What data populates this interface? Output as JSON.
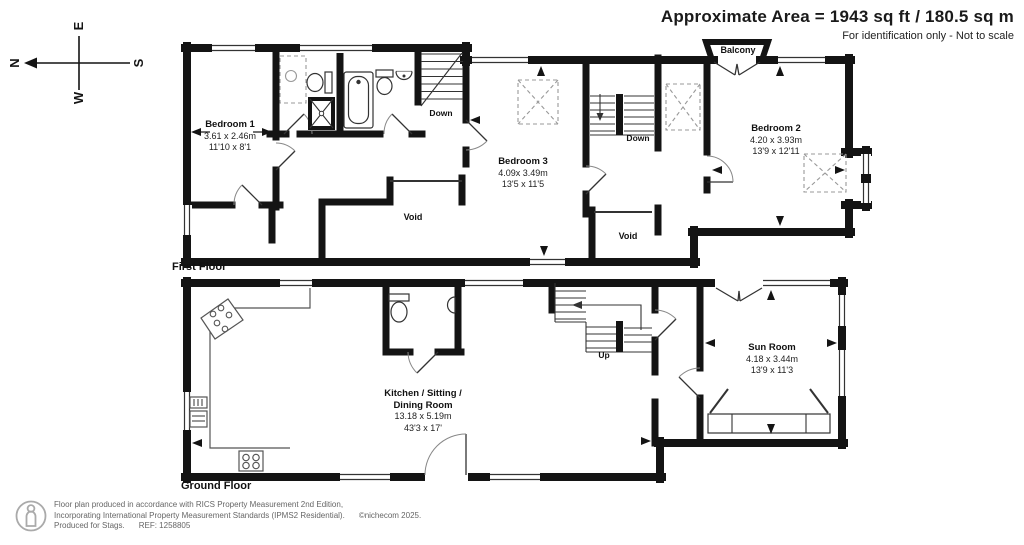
{
  "header": {
    "title": "Approximate Area = 1943 sq ft / 180.5 sq m",
    "subtitle": "For identification only - Not to scale"
  },
  "compass": {
    "north": "N",
    "south": "S",
    "east": "E",
    "west": "W"
  },
  "first_floor": {
    "label": "First Floor",
    "bedroom1": {
      "name": "Bedroom 1",
      "metric": "3.61 x 2.46m",
      "imperial": "11'10 x 8'1"
    },
    "bedroom3": {
      "name": "Bedroom 3",
      "metric": "4.09x 3.49m",
      "imperial": "13'5 x 11'5"
    },
    "bedroom2": {
      "name": "Bedroom 2",
      "metric": "4.20 x 3.93m",
      "imperial": "13'9 x 12'11"
    },
    "balcony": "Balcony",
    "void_left": "Void",
    "void_right": "Void",
    "down_left": "Down",
    "down_right": "Down"
  },
  "ground_floor": {
    "label": "Ground Floor",
    "kitchen": {
      "name1": "Kitchen / Sitting /",
      "name2": "Dining Room",
      "metric": "13.18 x 5.19m",
      "imperial": "43'3 x 17'"
    },
    "sunroom": {
      "name": "Sun Room",
      "metric": "4.18 x 3.44m",
      "imperial": "13'9 x 11'3"
    },
    "up": "Up"
  },
  "footer": {
    "line1": "Floor plan produced in accordance with RICS Property Measurement 2nd Edition,",
    "line2": "Incorporating International Property Measurement Standards (IPMS2 Residential).",
    "copyright": "©nichecom 2025.",
    "produced": "Produced for Stags.",
    "ref": "REF: 1258805"
  },
  "colors": {
    "wall": "#141414",
    "line": "#333333",
    "dashed": "#999999",
    "muted": "#666666"
  }
}
